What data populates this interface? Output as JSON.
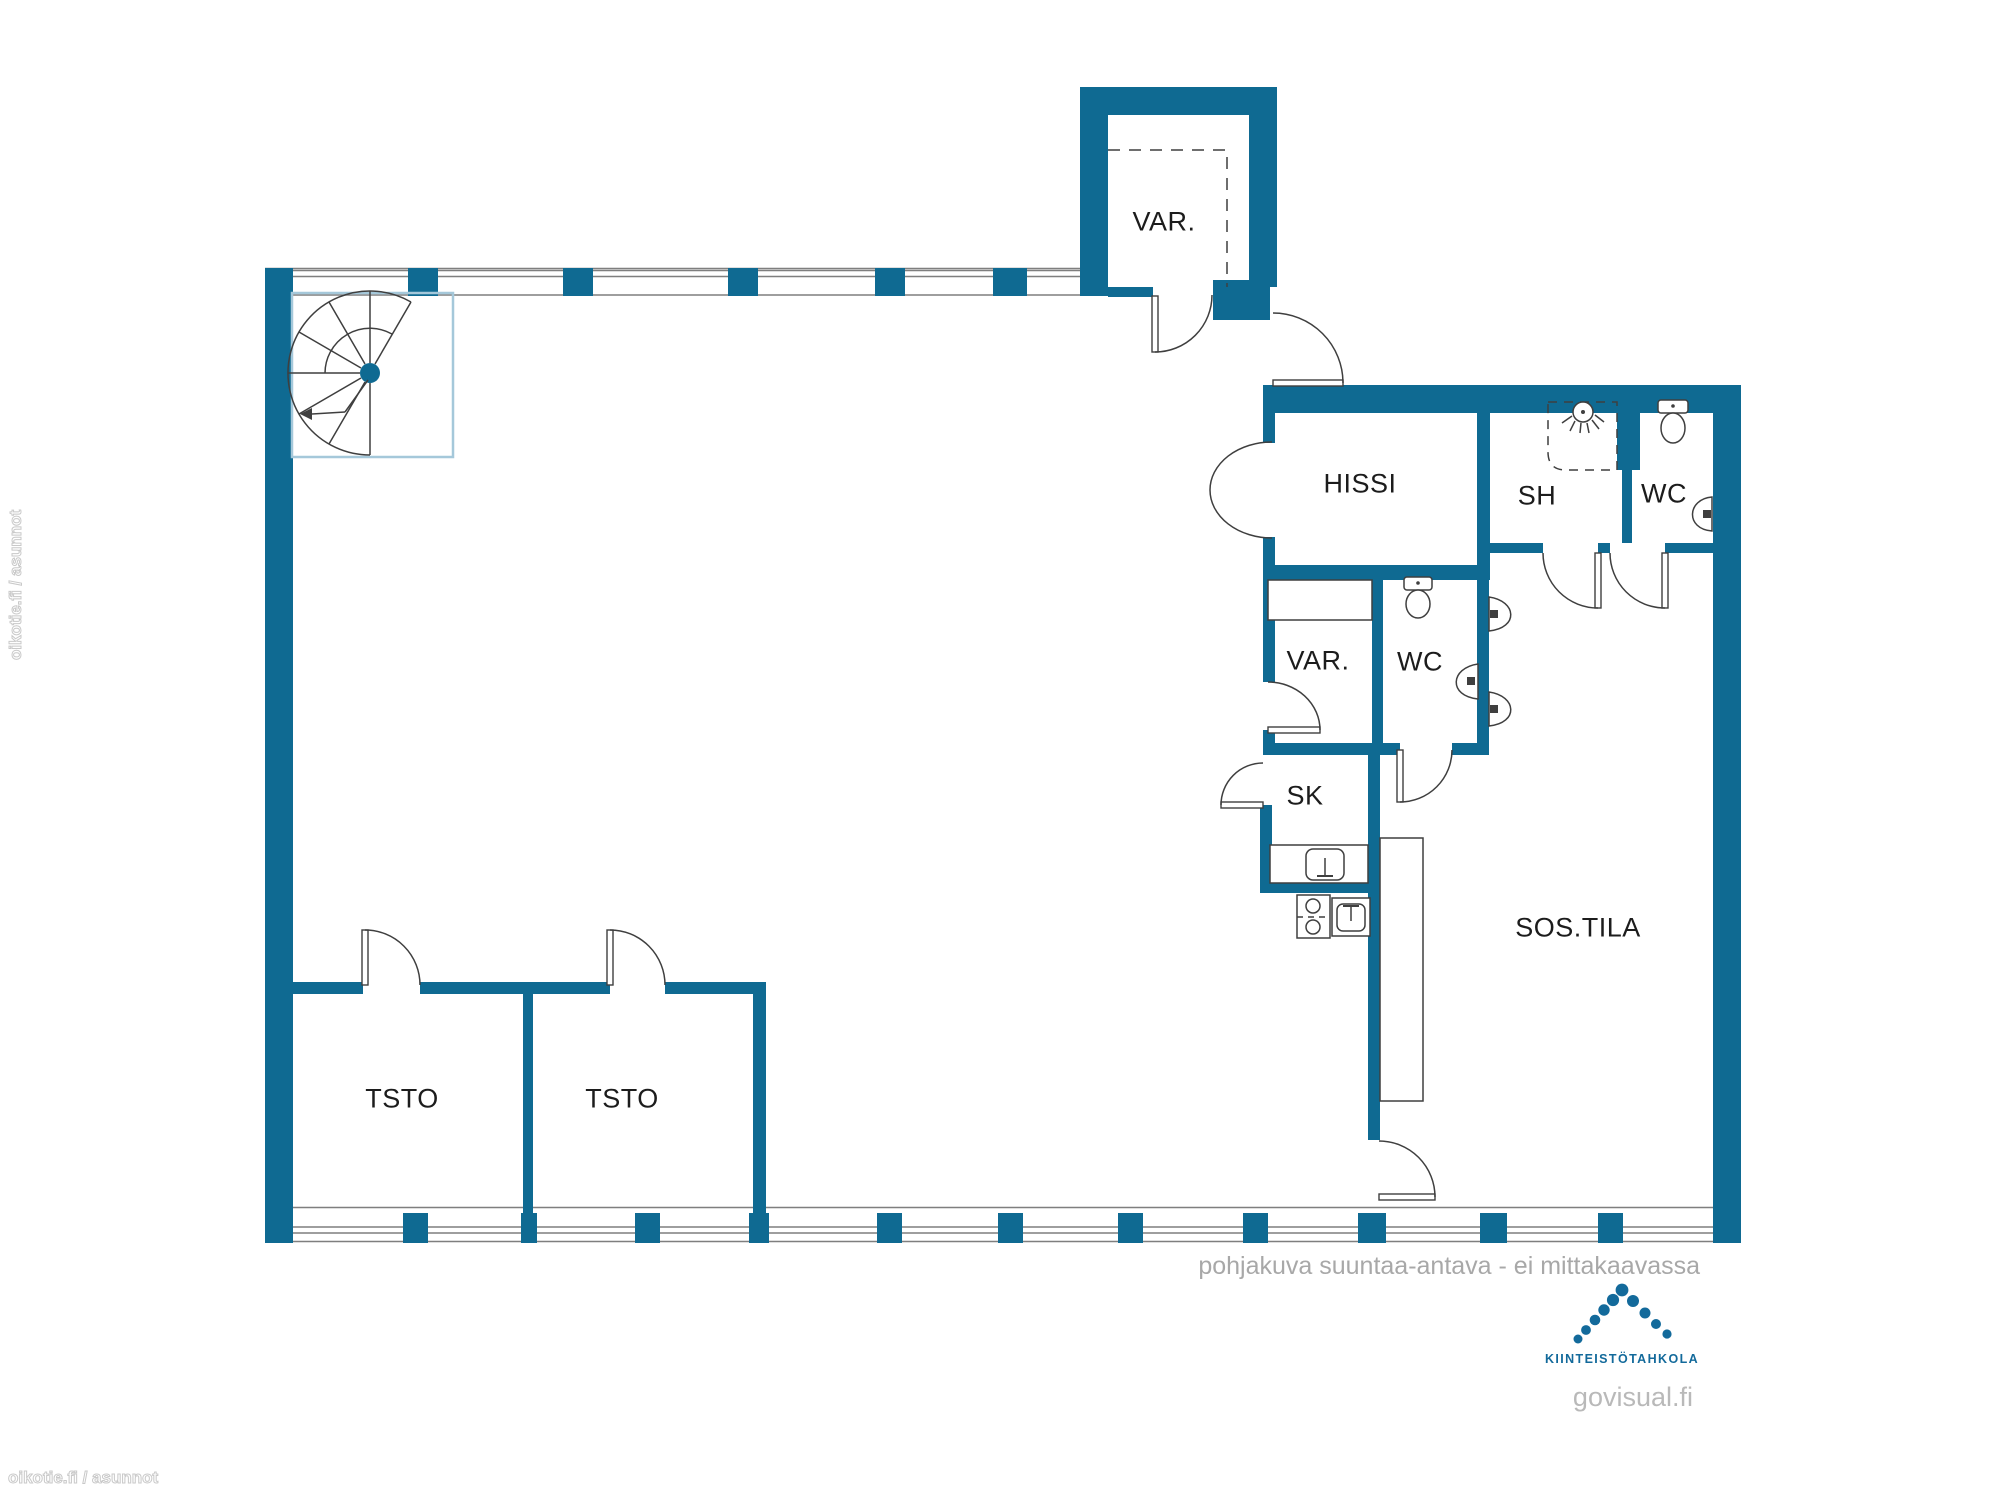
{
  "colors": {
    "wall": "#0f6a92",
    "accent_light": "#a5c8da",
    "line": "#3f3f3f",
    "window_line": "#7f7f7f",
    "label": "#1c1c1c",
    "footer_gray": "#a8a8a8",
    "brand_blue": "#136a9b",
    "watermark": "#c9c9c9"
  },
  "rooms": {
    "var_top": "VAR.",
    "hissi": "HISSI",
    "sh": "SH",
    "wc_top": "WC",
    "var_mid": "VAR.",
    "wc_mid": "WC",
    "sk": "SK",
    "sos_tila": "SOS.TILA",
    "tsto_1": "TSTO",
    "tsto_2": "TSTO"
  },
  "fixtures": [
    "spiral-staircase",
    "shower-enclosure",
    "shower-head",
    "toilet",
    "toilet",
    "wall-sink",
    "wall-sink",
    "wall-sink",
    "wall-sink",
    "cleaning-closet-sink",
    "stove",
    "kitchen-sink",
    "counter",
    "shelf"
  ],
  "footer": {
    "disclaimer": "pohjakuva suuntaa-antava - ei mittakaavassa",
    "brand": "KIINTEISTÖTAHKOLA",
    "site": "govisual.fi"
  },
  "watermark": {
    "text": "oikotie.fi / asunnot"
  }
}
